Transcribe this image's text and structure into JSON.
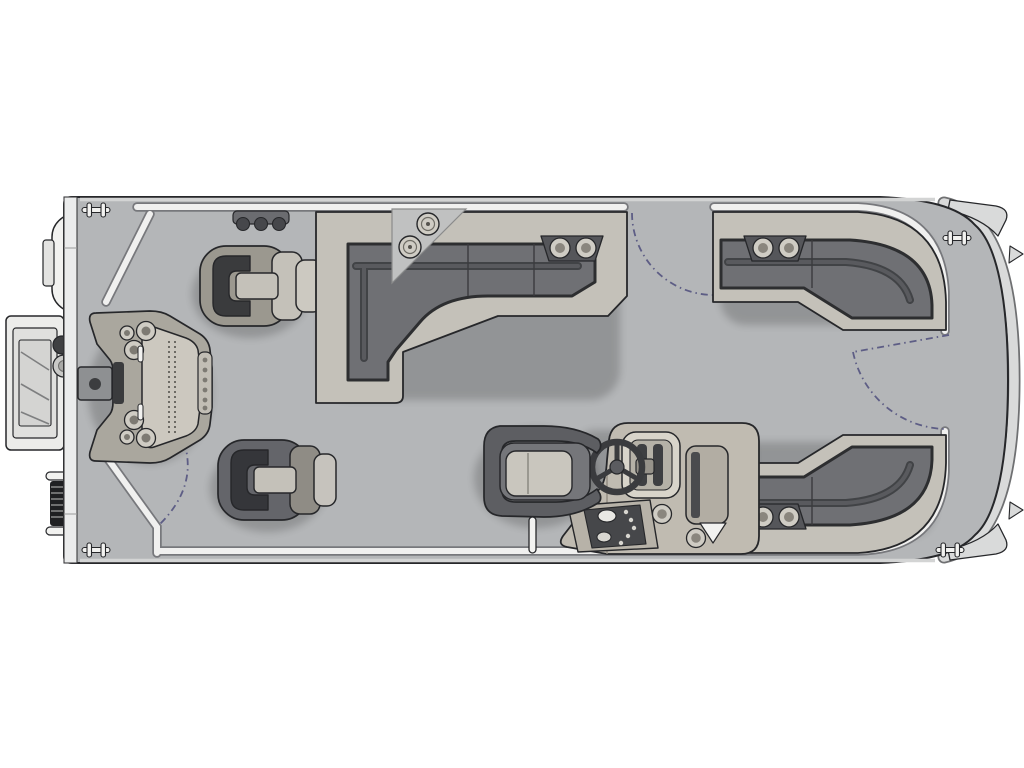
{
  "diagram": {
    "type": "floorplan",
    "subject": "pontoon-boat-deck-plan-top-view",
    "orientation": {
      "bow": "right",
      "stern": "left"
    },
    "visible_text": [],
    "features": [
      {
        "name": "stern-boarding-ladder",
        "location": "port stern exterior"
      },
      {
        "name": "stern-grab-rails",
        "count": 2
      },
      {
        "name": "bungee-coil",
        "count": 1
      },
      {
        "name": "mooring-cleats",
        "count": 4
      },
      {
        "name": "rod-holder-bracket",
        "knobs": 3
      },
      {
        "name": "fishing-pedestal-chair",
        "count": 2
      },
      {
        "name": "stern-fishing-station",
        "cupholders": 6,
        "rod-tubes": 6
      },
      {
        "name": "pedestal-table-mount",
        "count": 1
      },
      {
        "name": "port-l-lounge",
        "armrest_cupholders": 2
      },
      {
        "name": "deck-corner-cupholders",
        "count": 2
      },
      {
        "name": "captain-chair",
        "count": 1
      },
      {
        "name": "helm-console",
        "items": [
          "steering-wheel",
          "gauge-panel",
          "switch-panel",
          "cupholders",
          "storage-box"
        ]
      },
      {
        "name": "ski-tow-post",
        "count": 1
      },
      {
        "name": "bow-port-lounge",
        "armrest_cupholders": 2
      },
      {
        "name": "bow-starboard-lounge",
        "armrest_cupholders": 2
      },
      {
        "name": "gate",
        "count": 3,
        "positions": [
          "stern-port-quarter",
          "port-midship",
          "bow-center"
        ],
        "swing_arcs_shown": true
      },
      {
        "name": "bow-nose-cones",
        "count": 2
      }
    ],
    "palette": {
      "bg": "#ffffff",
      "deck": "#b4b6b8",
      "hullBand": "#ebecec",
      "fenceFill": "#f0f0ef",
      "fenceEdge": "#77787c",
      "outline": "#26272a",
      "seatBase": "#c4c1b9",
      "seatMid": "#aaa79e",
      "cushion": "#6f7074",
      "cushionDeep": "#4b4c50",
      "crease": "#2d2e30",
      "chairDark": "#64656a",
      "chairPale": "#9b988f",
      "arcBlue": "#5d5d85",
      "consoleBody": "#c0bbb1",
      "panelDark": "#46474a",
      "whitePart": "#f2f2f0",
      "ringFill": "#cfccc4",
      "trim": "#d9dada"
    }
  }
}
